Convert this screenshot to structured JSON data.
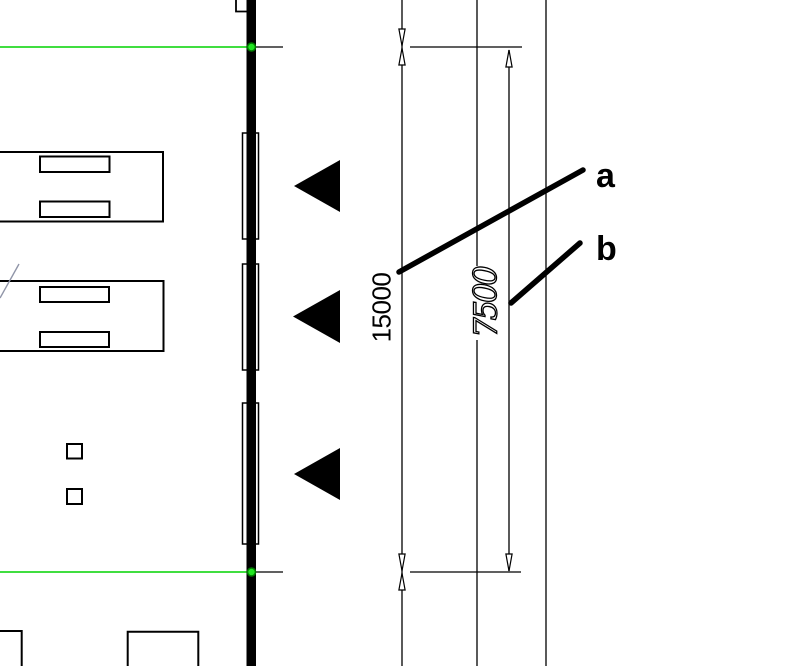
{
  "drawing": {
    "dimensions": {
      "total_width": {
        "value": "15000"
      },
      "half_width": {
        "value": "7500"
      }
    },
    "leader_labels": {
      "a": "a",
      "b": "b"
    },
    "icons": {
      "direction_triangle": "left-pointing-solid-triangle",
      "dimension_arrow": "open-slender-arrowhead",
      "survey_marker": "green-circle-marker"
    },
    "colors": {
      "ink": "#000000",
      "background": "#ffffff",
      "boundary_green": "#00d400",
      "marker_fill": "#22e622",
      "marker_stroke": "#007a00",
      "stray_line": "#9095a8"
    }
  }
}
